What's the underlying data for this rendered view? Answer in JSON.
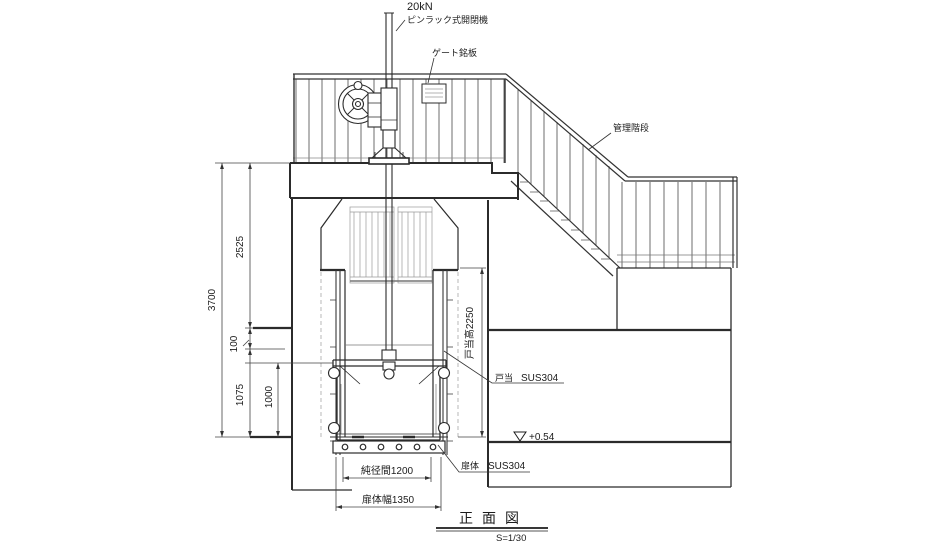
{
  "annotations": {
    "hoist_capacity": "20kN",
    "hoist_type": "ピンラック式開閉機",
    "gate_nameplate": "ゲート銘板",
    "stairs": "管理階段",
    "doorstop": {
      "label": "戸当",
      "material": "SUS304"
    },
    "leaf": {
      "label": "扉体",
      "material": "SUS304"
    },
    "elevation_mark": "+0.54"
  },
  "dimensions": {
    "overall_height": "3700",
    "upper_height": "2525",
    "offset": "100",
    "lower_height": "1075",
    "gate_height": "1000",
    "doorstop_height": "戸当高2250",
    "clear_span": "純径間1200",
    "leaf_width": "扉体幅1350"
  },
  "title_block": {
    "title": "正面図",
    "scale": "S=1/30"
  },
  "colors": {
    "line": "#2b2b2b",
    "light_line": "#9a9a9a",
    "background": "#ffffff"
  }
}
